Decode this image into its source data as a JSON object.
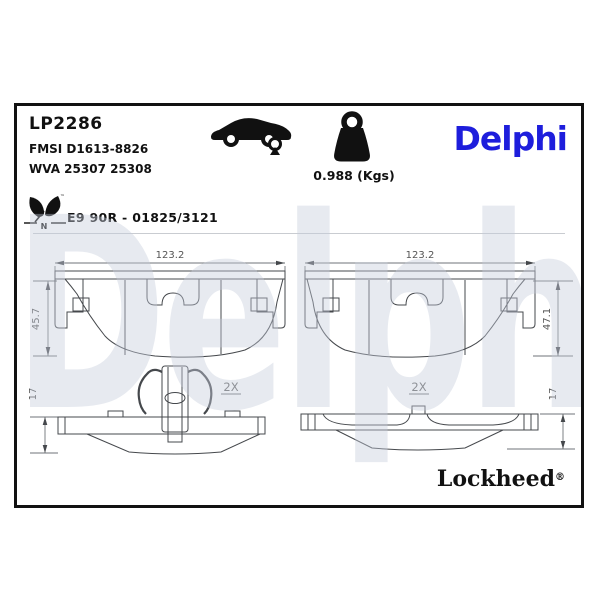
{
  "header": {
    "part_number": "LP2286",
    "fmsi_ref": "FMSI D1613-8826",
    "wva_ref": "WVA 25307 25308",
    "weight": "0.988 (Kgs)",
    "brand_logo": "Delphi",
    "approval_code": "E9 90R - 01825/3121",
    "eco_marking": {
      "axle_letter": "N",
      "trademark": "™"
    }
  },
  "drawings": {
    "pad_front_left": {
      "width": "123.2",
      "height": "45.7"
    },
    "pad_front_right": {
      "width": "123.2",
      "height": "47.1"
    },
    "pad_edge_left": {
      "thickness": "17",
      "quantity": "2X"
    },
    "pad_edge_right": {
      "thickness": "17",
      "quantity": "2X"
    }
  },
  "watermark": {
    "text": "Delphi"
  },
  "footer": {
    "sub_brand": "Lockheed",
    "registered": "®"
  },
  "colors": {
    "brand_blue": "#1E1EDC",
    "watermark_tint": "#E9EBF2",
    "friction_gray": "#CFD3D9",
    "frame_border": "#111111"
  }
}
